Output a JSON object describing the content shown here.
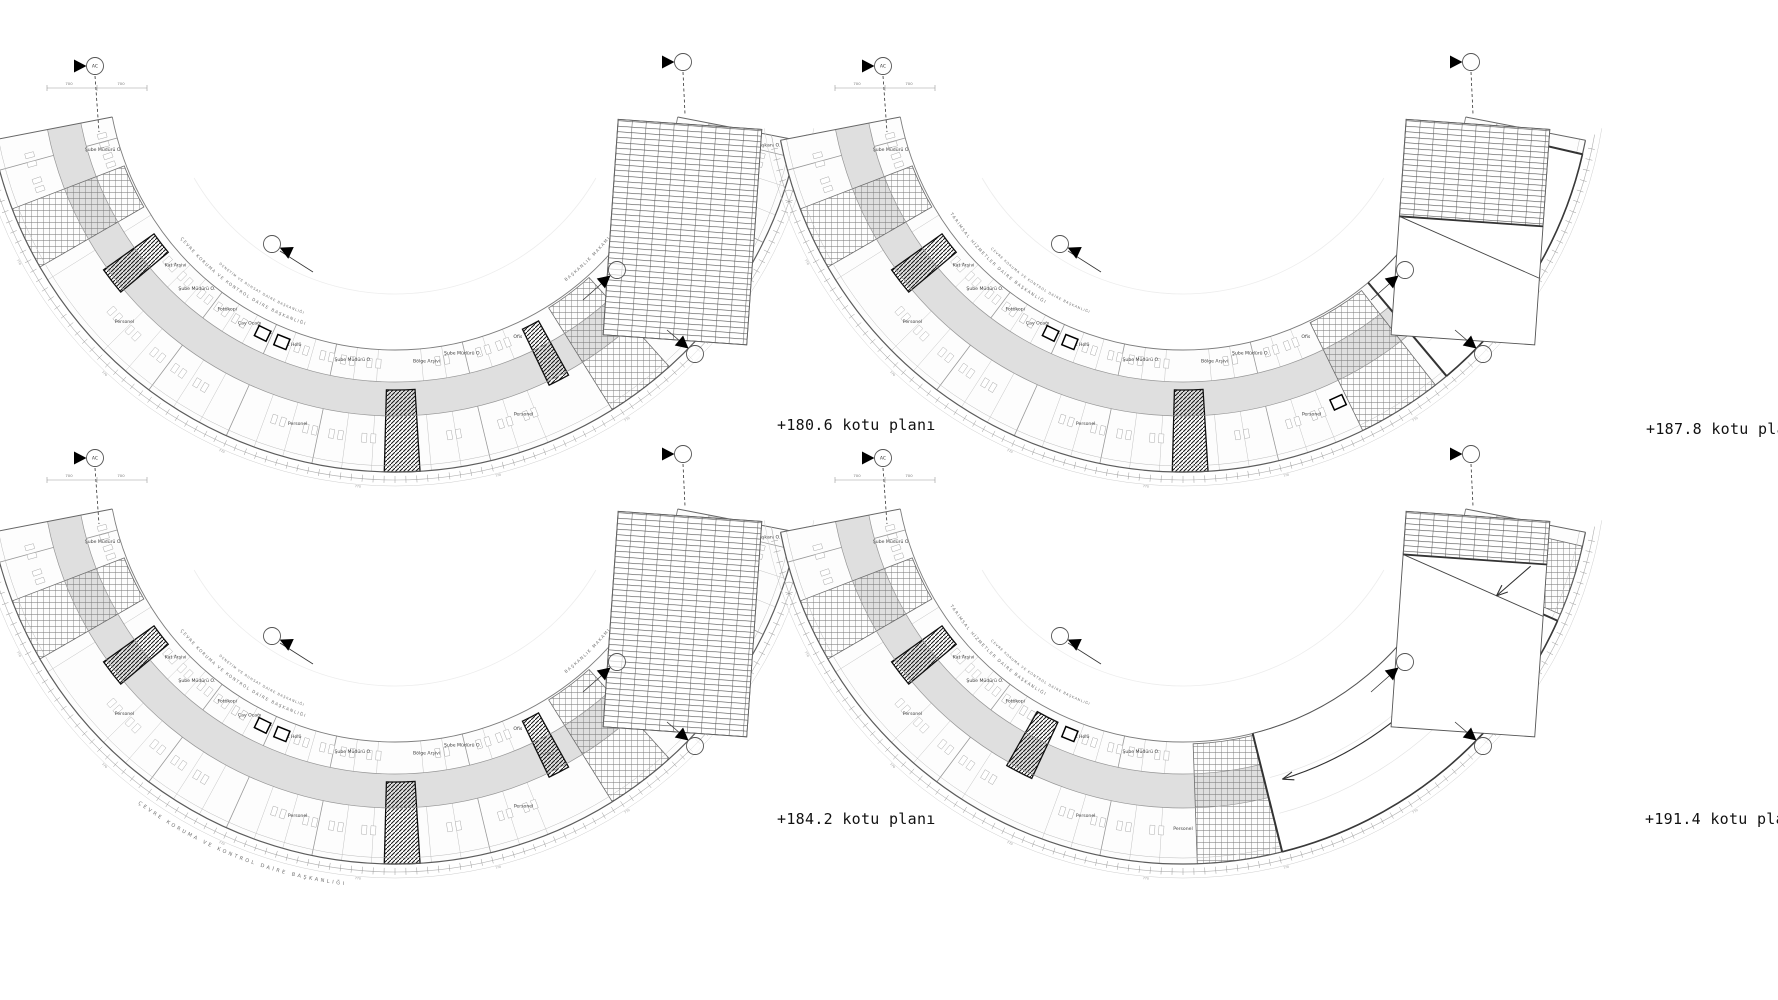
{
  "sheet": {
    "kind": "kat planları (floor plans)",
    "background": "#ffffff"
  },
  "colors": {
    "paper": "#ffffff",
    "band_fill": "#fdfdfd",
    "corridor_fill": "#dcdcdc",
    "wall_dark": "#555555",
    "wall_mid": "#8a8a8a",
    "partition_light": "#c4c4c4",
    "core_hatch": "#111111",
    "caption_text": "#111111",
    "muted_text": "#6f6f6f",
    "tick": "#9a9a9a"
  },
  "shared": {
    "arc_tick_label": "770",
    "dim_labels": [
      "700",
      "700"
    ],
    "desk_angles": [
      165,
      161,
      157,
      153,
      149,
      145,
      138,
      134,
      129,
      125,
      121,
      108,
      103,
      99,
      94,
      89,
      81,
      73,
      69,
      62,
      54,
      33,
      26,
      19,
      15
    ],
    "room_labels": [
      {
        "t": "Şube Müdürü O.",
        "a": 163,
        "r": 305
      },
      {
        "t": "Daire Başkanı O.",
        "a": 156,
        "r": 303
      },
      {
        "t": "Personel",
        "a": 158,
        "r": 376
      },
      {
        "t": "Sekreter",
        "a": 149,
        "r": 300
      },
      {
        "t": "Toplantı O.",
        "a": 143,
        "r": 302
      },
      {
        "t": "Kat Arşivi",
        "a": 137,
        "r": 300
      },
      {
        "t": "Şube Müdürü O.",
        "a": 131,
        "r": 302
      },
      {
        "t": "Personel",
        "a": 136,
        "r": 376
      },
      {
        "t": "Fotokopi",
        "a": 124,
        "r": 300
      },
      {
        "t": "Çay Ocağı",
        "a": 119,
        "r": 300
      },
      {
        "t": "WC",
        "a": 115,
        "r": 300
      },
      {
        "t": "Kat Holü",
        "a": 110,
        "r": 302
      },
      {
        "t": "Personel",
        "a": 105,
        "r": 376
      },
      {
        "t": "Şube Müdürü O.",
        "a": 98,
        "r": 302
      },
      {
        "t": "Personel",
        "a": 90,
        "r": 376
      },
      {
        "t": "Bölge Arşivi",
        "a": 84,
        "r": 302
      },
      {
        "t": "Şube Müdürü O.",
        "a": 77,
        "r": 300
      },
      {
        "t": "Personel",
        "a": 70,
        "r": 376
      },
      {
        "t": "Ofis",
        "a": 66,
        "r": 302
      },
      {
        "t": "Daire Başkanı O.",
        "a": 60,
        "r": 376
      },
      {
        "t": "Müdürlük Kalemi",
        "a": 61,
        "r": 376
      },
      {
        "t": "Özel Kalem Müdürü",
        "a": 45,
        "r": 378
      },
      {
        "t": "Başkan Sekreteryası",
        "a": 44,
        "r": 368
      },
      {
        "t": "Makam Çalışma ve Dinlenme O.",
        "a": 36,
        "r": 368
      },
      {
        "t": "Makam O.",
        "a": 28,
        "r": 340
      },
      {
        "t": "Kat Arşivi",
        "a": 21,
        "r": 302
      },
      {
        "t": "Sekreter",
        "a": 16,
        "r": 330
      },
      {
        "t": "Daire Başkanı O.",
        "a": 13,
        "r": 376
      }
    ],
    "markers": [
      {
        "x": 100,
        "y": 18,
        "rot": 180,
        "label": "AC",
        "leader": [
          100,
          28,
          104,
          84
        ],
        "dash": true
      },
      {
        "x": 688,
        "y": 14,
        "rot": 180,
        "label": "",
        "leader": [
          688,
          24,
          690,
          66
        ],
        "dash": true
      },
      {
        "x": 277,
        "y": 196,
        "rot": 25,
        "label": "",
        "leader": [
          285,
          203,
          318,
          224
        ],
        "dash": false
      },
      {
        "x": 622,
        "y": 222,
        "rot": 140,
        "label": "",
        "leader": [
          614,
          229,
          588,
          252
        ],
        "dash": false
      },
      {
        "x": 700,
        "y": 306,
        "rot": -140,
        "label": "",
        "leader": [
          693,
          300,
          672,
          282
        ],
        "dash": false
      }
    ],
    "core_squares": [
      [
        58.5,
        374
      ],
      [
        62,
        374
      ],
      [
        65.5,
        374
      ],
      [
        112,
        302
      ],
      [
        116,
        302
      ],
      [
        20,
        332
      ],
      [
        23.5,
        332
      ]
    ]
  },
  "plans": [
    {
      "id": "180-6",
      "caption": "+180.6 kotu planı",
      "origin": {
        "x": -5,
        "y": 48
      },
      "empty_span": null,
      "arrow": null,
      "roof_grid_fraction": 1,
      "grid_blocks": [
        [
          48,
          58
        ],
        [
          150,
          159
        ]
      ],
      "dark_blocks": [
        [
          86.5,
          91.5,
          328,
          410
        ],
        [
          140,
          144.5,
          296,
          358
        ],
        [
          61,
          64.5,
          296,
          358
        ]
      ],
      "curved_texts": [
        {
          "r": 278,
          "offset": "18%",
          "text": "ÇEVRE KORUMA VE KONTROL DAİRE BAŞKANLIĞI",
          "size": 4.2,
          "spacing": 1.3
        },
        {
          "r": 268,
          "offset": "24%",
          "text": "DENETİM VE RUHSAT DAİRE BAŞKANLIĞI",
          "size": 3.4,
          "spacing": 0.9
        },
        {
          "r": 278,
          "offset": "74%",
          "text": "BAŞKANLIK MAKAMI",
          "size": 4.2,
          "spacing": 1.3
        }
      ],
      "extra_labels": []
    },
    {
      "id": "187-8",
      "caption": "+187.8 kotu planı",
      "origin": {
        "x": 783,
        "y": 48
      },
      "empty_span": [
        13,
        50
      ],
      "arrow": "corner",
      "roof_grid_fraction": 0.45,
      "grid_blocks": [
        [
          52,
          64
        ],
        [
          150,
          159
        ]
      ],
      "dark_blocks": [
        [
          86.5,
          91.5,
          328,
          410
        ],
        [
          140,
          144.5,
          296,
          358
        ]
      ],
      "curved_texts": [
        {
          "r": 278,
          "offset": "14%",
          "text": "TARIMSAL HİZMETLER DAİRE BAŞKANLIĞI",
          "size": 4.2,
          "spacing": 1.3
        },
        {
          "r": 268,
          "offset": "21%",
          "text": "ÇEVRE KORUMA VE KONTROL DAİRE BAŞKANLIĞI",
          "size": 3.4,
          "spacing": 0.9
        }
      ],
      "extra_labels": []
    },
    {
      "id": "184-2",
      "caption": "+184.2 kotu planı",
      "origin": {
        "x": -5,
        "y": 440
      },
      "empty_span": null,
      "arrow": null,
      "roof_grid_fraction": 1,
      "grid_blocks": [
        [
          48,
          58
        ],
        [
          150,
          159
        ]
      ],
      "dark_blocks": [
        [
          86.5,
          91.5,
          328,
          410
        ],
        [
          140,
          144.5,
          296,
          358
        ],
        [
          61,
          64.5,
          296,
          358
        ]
      ],
      "curved_texts": [
        {
          "r": 278,
          "offset": "18%",
          "text": "ÇEVRE KORUMA VE KONTROL DAİRE BAŞKANLIĞI",
          "size": 4.2,
          "spacing": 1.3
        },
        {
          "r": 268,
          "offset": "24%",
          "text": "DENETİM VE RUHSAT DAİRE BAŞKANLIĞI",
          "size": 3.4,
          "spacing": 0.9
        },
        {
          "r": 278,
          "offset": "74%",
          "text": "BAŞKANLIK MAKAMI",
          "size": 4.2,
          "spacing": 1.3
        },
        {
          "r": 434,
          "offset": "27%",
          "text": "ÇEVRE KORUMA VE KONTROL DAİRE BAŞKANLIĞI",
          "size": 5,
          "spacing": 2.6
        }
      ],
      "extra_labels": [
        {
          "t": "+178.2",
          "a": 63,
          "r": 337,
          "s": 3.5
        }
      ]
    },
    {
      "id": "191-4",
      "caption": "+191.4 kotu planı",
      "origin": {
        "x": 783,
        "y": 440
      },
      "empty_span": [
        24,
        76
      ],
      "arrow": "sweep",
      "roof_grid_fraction": 0.2,
      "grid_blocks": [
        [
          76,
          88
        ],
        [
          13,
          23
        ],
        [
          150,
          159
        ]
      ],
      "dark_blocks": [
        [
          115,
          119.5,
          296,
          358
        ],
        [
          140,
          144.5,
          296,
          358
        ]
      ],
      "curved_texts": [
        {
          "r": 278,
          "offset": "14%",
          "text": "TARIMSAL HİZMETLER DAİRE BAŞKANLIĞI",
          "size": 4.2,
          "spacing": 1.3
        },
        {
          "r": 268,
          "offset": "21%",
          "text": "ÇEVRE KORUMA VE KONTROL DAİRE BAŞKANLIĞI",
          "size": 3.4,
          "spacing": 0.9
        }
      ],
      "extra_labels": []
    }
  ]
}
